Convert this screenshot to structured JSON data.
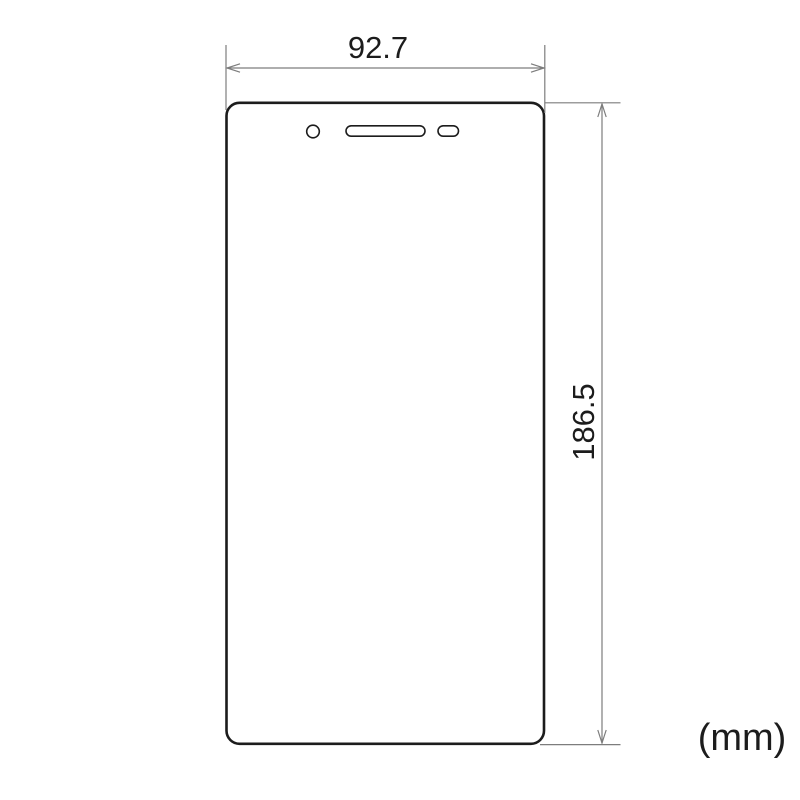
{
  "diagram": {
    "width_dimension_label": "92.7",
    "height_dimension_label": "186.5",
    "unit_label": "(mm)"
  },
  "shapes": {
    "protector": "screen-protector-outline",
    "cutouts": [
      "camera-hole",
      "speaker-slot",
      "small-slot"
    ]
  },
  "colors": {
    "background": "#ffffff",
    "outline": "#1c1c1c",
    "dimension_line": "#7d7d7d",
    "label_text": "#1c1c1c"
  }
}
